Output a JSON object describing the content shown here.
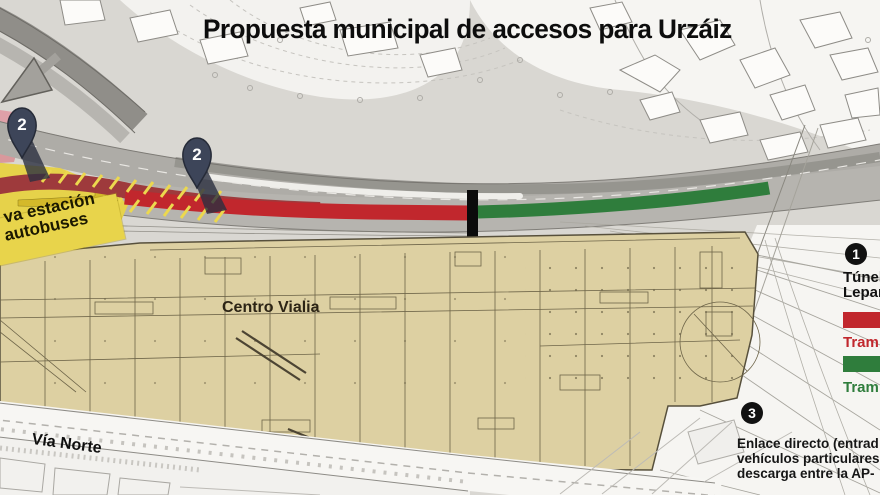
{
  "title": "Propuesta municipal de accesos para Urzáiz",
  "map_labels": {
    "station_line1": "va estación",
    "station_line2": "autobuses",
    "building": "Centro Vialia",
    "road": "Vía Norte"
  },
  "markers": {
    "pin_left": "2",
    "pin_right": "2"
  },
  "legend": {
    "item1_number": "1",
    "item1_line1": "Túnel",
    "item1_line2": "Lepan",
    "red_label": "Tram",
    "green_label": "Tram",
    "item3_number": "3",
    "item3_line1": "Enlace directo (entrad",
    "item3_line2": "vehículos particulares",
    "item3_line3": "descarga entre la AP-"
  },
  "colors": {
    "route_red": "#c1272d",
    "route_red_dark": "#9e3a3c",
    "route_green": "#2f7d3c",
    "station_yellow": "#e8d44b",
    "building_tan": "#ddd0a2",
    "building_line": "#6e6549",
    "road_gray": "#b2b0ab",
    "pin_blue": "#3d4559",
    "legend_black": "#111111"
  }
}
